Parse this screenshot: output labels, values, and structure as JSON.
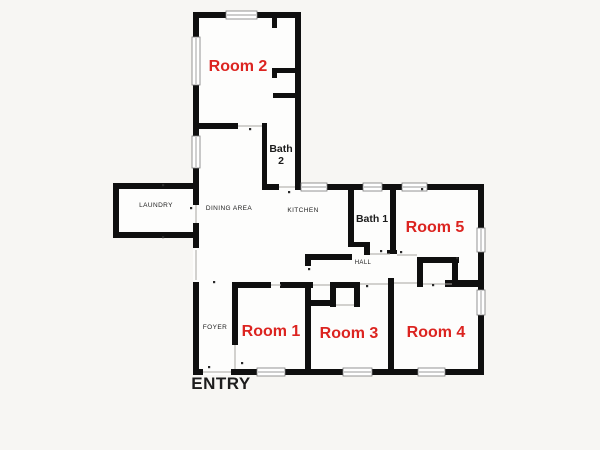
{
  "title": "5-room house floor plan",
  "colors": {
    "background": "#f7f6f3",
    "plan_fill": "#fdfdfc",
    "wall": "#0f0f0f",
    "room_label": "#dc2420",
    "text_label": "#1c1c1c",
    "door_line": "#a8a5a0",
    "window_frame": "#7a7a7a",
    "window_fill": "#ffffff",
    "tick": "#2a2a2a"
  },
  "room_labels": [
    {
      "id": "room-2",
      "text": "Room 2",
      "x": 238,
      "y": 71,
      "size": 16
    },
    {
      "id": "room-5",
      "text": "Room 5",
      "x": 435,
      "y": 232,
      "size": 16
    },
    {
      "id": "room-1",
      "text": "Room 1",
      "x": 271,
      "y": 336,
      "size": 16
    },
    {
      "id": "room-3",
      "text": "Room 3",
      "x": 349,
      "y": 338,
      "size": 16
    },
    {
      "id": "room-4",
      "text": "Room 4",
      "x": 436,
      "y": 337,
      "size": 16
    }
  ],
  "area_labels": [
    {
      "id": "bath-2",
      "lines": [
        "Bath",
        "2"
      ],
      "x": 281,
      "y": 152,
      "size": 10.5,
      "weight": "bold",
      "spacing": 0
    },
    {
      "id": "bath-1",
      "lines": [
        "Bath 1"
      ],
      "x": 372,
      "y": 222,
      "size": 10.5,
      "weight": "bold",
      "spacing": 0
    },
    {
      "id": "laundry",
      "lines": [
        "LAUNDRY"
      ],
      "x": 156,
      "y": 207,
      "size": 6.5,
      "weight": "normal",
      "spacing": 0.4
    },
    {
      "id": "dining-area",
      "lines": [
        "DINING AREA"
      ],
      "x": 229,
      "y": 210,
      "size": 6.5,
      "weight": "normal",
      "spacing": 0.4
    },
    {
      "id": "kitchen",
      "lines": [
        "KITCHEN"
      ],
      "x": 303,
      "y": 212,
      "size": 6.5,
      "weight": "normal",
      "spacing": 0.4
    },
    {
      "id": "hall",
      "lines": [
        "HALL"
      ],
      "x": 363,
      "y": 264,
      "size": 6,
      "weight": "normal",
      "spacing": 0.4
    },
    {
      "id": "foyer",
      "lines": [
        "FOYER"
      ],
      "x": 215,
      "y": 329,
      "size": 6.5,
      "weight": "normal",
      "spacing": 0.4
    },
    {
      "id": "entry",
      "lines": [
        "ENTRY"
      ],
      "x": 221,
      "y": 389,
      "size": 17,
      "weight": "bold",
      "spacing": 0.5
    }
  ],
  "geometry": {
    "interior_fills": [
      [
        193,
        12,
        108,
        178
      ],
      [
        113,
        183,
        86,
        55
      ],
      [
        193,
        129,
        108,
        61
      ],
      [
        193,
        184,
        291,
        191
      ]
    ],
    "walls": [
      [
        193,
        12,
        33,
        6
      ],
      [
        257,
        12,
        44,
        6
      ],
      [
        193,
        12,
        6,
        26
      ],
      [
        193,
        85,
        6,
        51
      ],
      [
        193,
        168,
        6,
        21
      ],
      [
        295,
        12,
        6,
        178
      ],
      [
        272,
        18,
        5,
        10
      ],
      [
        272,
        68,
        23,
        5
      ],
      [
        272,
        68,
        5,
        10
      ],
      [
        273,
        93,
        22,
        5
      ],
      [
        193,
        123,
        45,
        6
      ],
      [
        262,
        123,
        5,
        67
      ],
      [
        262,
        184,
        17,
        6
      ],
      [
        113,
        183,
        86,
        6
      ],
      [
        113,
        183,
        6,
        55
      ],
      [
        113,
        232,
        86,
        6
      ],
      [
        193,
        189,
        6,
        16
      ],
      [
        193,
        223,
        6,
        25
      ],
      [
        193,
        282,
        6,
        93
      ],
      [
        327,
        184,
        36,
        6
      ],
      [
        382,
        184,
        20,
        6
      ],
      [
        427,
        184,
        57,
        6
      ],
      [
        478,
        184,
        6,
        44
      ],
      [
        478,
        252,
        6,
        38
      ],
      [
        478,
        315,
        6,
        60
      ],
      [
        193,
        369,
        10,
        6
      ],
      [
        231,
        369,
        26,
        6
      ],
      [
        285,
        369,
        58,
        6
      ],
      [
        372,
        369,
        46,
        6
      ],
      [
        445,
        369,
        39,
        6
      ],
      [
        348,
        190,
        6,
        52
      ],
      [
        348,
        242,
        22,
        5
      ],
      [
        364,
        242,
        6,
        13
      ],
      [
        390,
        190,
        6,
        62
      ],
      [
        387,
        250,
        10,
        4
      ],
      [
        305,
        254,
        47,
        6
      ],
      [
        305,
        254,
        6,
        12
      ],
      [
        417,
        257,
        42,
        6
      ],
      [
        417,
        257,
        6,
        30
      ],
      [
        452,
        260,
        6,
        27
      ],
      [
        445,
        280,
        33,
        7
      ],
      [
        232,
        282,
        39,
        6
      ],
      [
        280,
        282,
        33,
        6
      ],
      [
        330,
        282,
        30,
        6
      ],
      [
        330,
        282,
        6,
        25
      ],
      [
        354,
        282,
        6,
        25
      ],
      [
        311,
        300,
        24,
        6
      ],
      [
        232,
        282,
        6,
        63
      ],
      [
        305,
        282,
        6,
        93
      ],
      [
        388,
        278,
        6,
        97
      ]
    ],
    "door_openings": [
      [
        238,
        126,
        262,
        126
      ],
      [
        279,
        187,
        295,
        187
      ],
      [
        196,
        205,
        196,
        223
      ],
      [
        196,
        250,
        196,
        280
      ],
      [
        203,
        372,
        231,
        372
      ],
      [
        235,
        345,
        235,
        369
      ],
      [
        271,
        285,
        281,
        285
      ],
      [
        313,
        285,
        330,
        285
      ],
      [
        360,
        284,
        388,
        284
      ],
      [
        336,
        305,
        354,
        305
      ],
      [
        394,
        283,
        417,
        283
      ],
      [
        423,
        284,
        452,
        284
      ],
      [
        370,
        254,
        390,
        254
      ],
      [
        397,
        255,
        417,
        255
      ]
    ],
    "windows": [
      [
        226,
        11,
        31,
        8
      ],
      [
        192,
        37,
        8,
        48
      ],
      [
        192,
        136,
        8,
        32
      ],
      [
        301,
        183,
        26,
        8
      ],
      [
        363,
        183,
        19,
        8
      ],
      [
        402,
        183,
        25,
        8
      ],
      [
        477,
        228,
        8,
        24
      ],
      [
        477,
        290,
        8,
        25
      ],
      [
        257,
        368,
        28,
        8
      ],
      [
        343,
        368,
        29,
        8
      ],
      [
        418,
        368,
        27,
        8
      ]
    ],
    "ticks": [
      [
        208,
        366
      ],
      [
        213,
        281
      ],
      [
        241,
        362
      ],
      [
        190,
        207
      ],
      [
        366,
        285
      ],
      [
        432,
        284
      ],
      [
        380,
        250
      ],
      [
        400,
        251
      ],
      [
        308,
        268
      ],
      [
        249,
        128
      ],
      [
        288,
        191
      ],
      [
        162,
        184
      ],
      [
        162,
        236
      ],
      [
        456,
        257
      ],
      [
        421,
        188
      ]
    ]
  }
}
